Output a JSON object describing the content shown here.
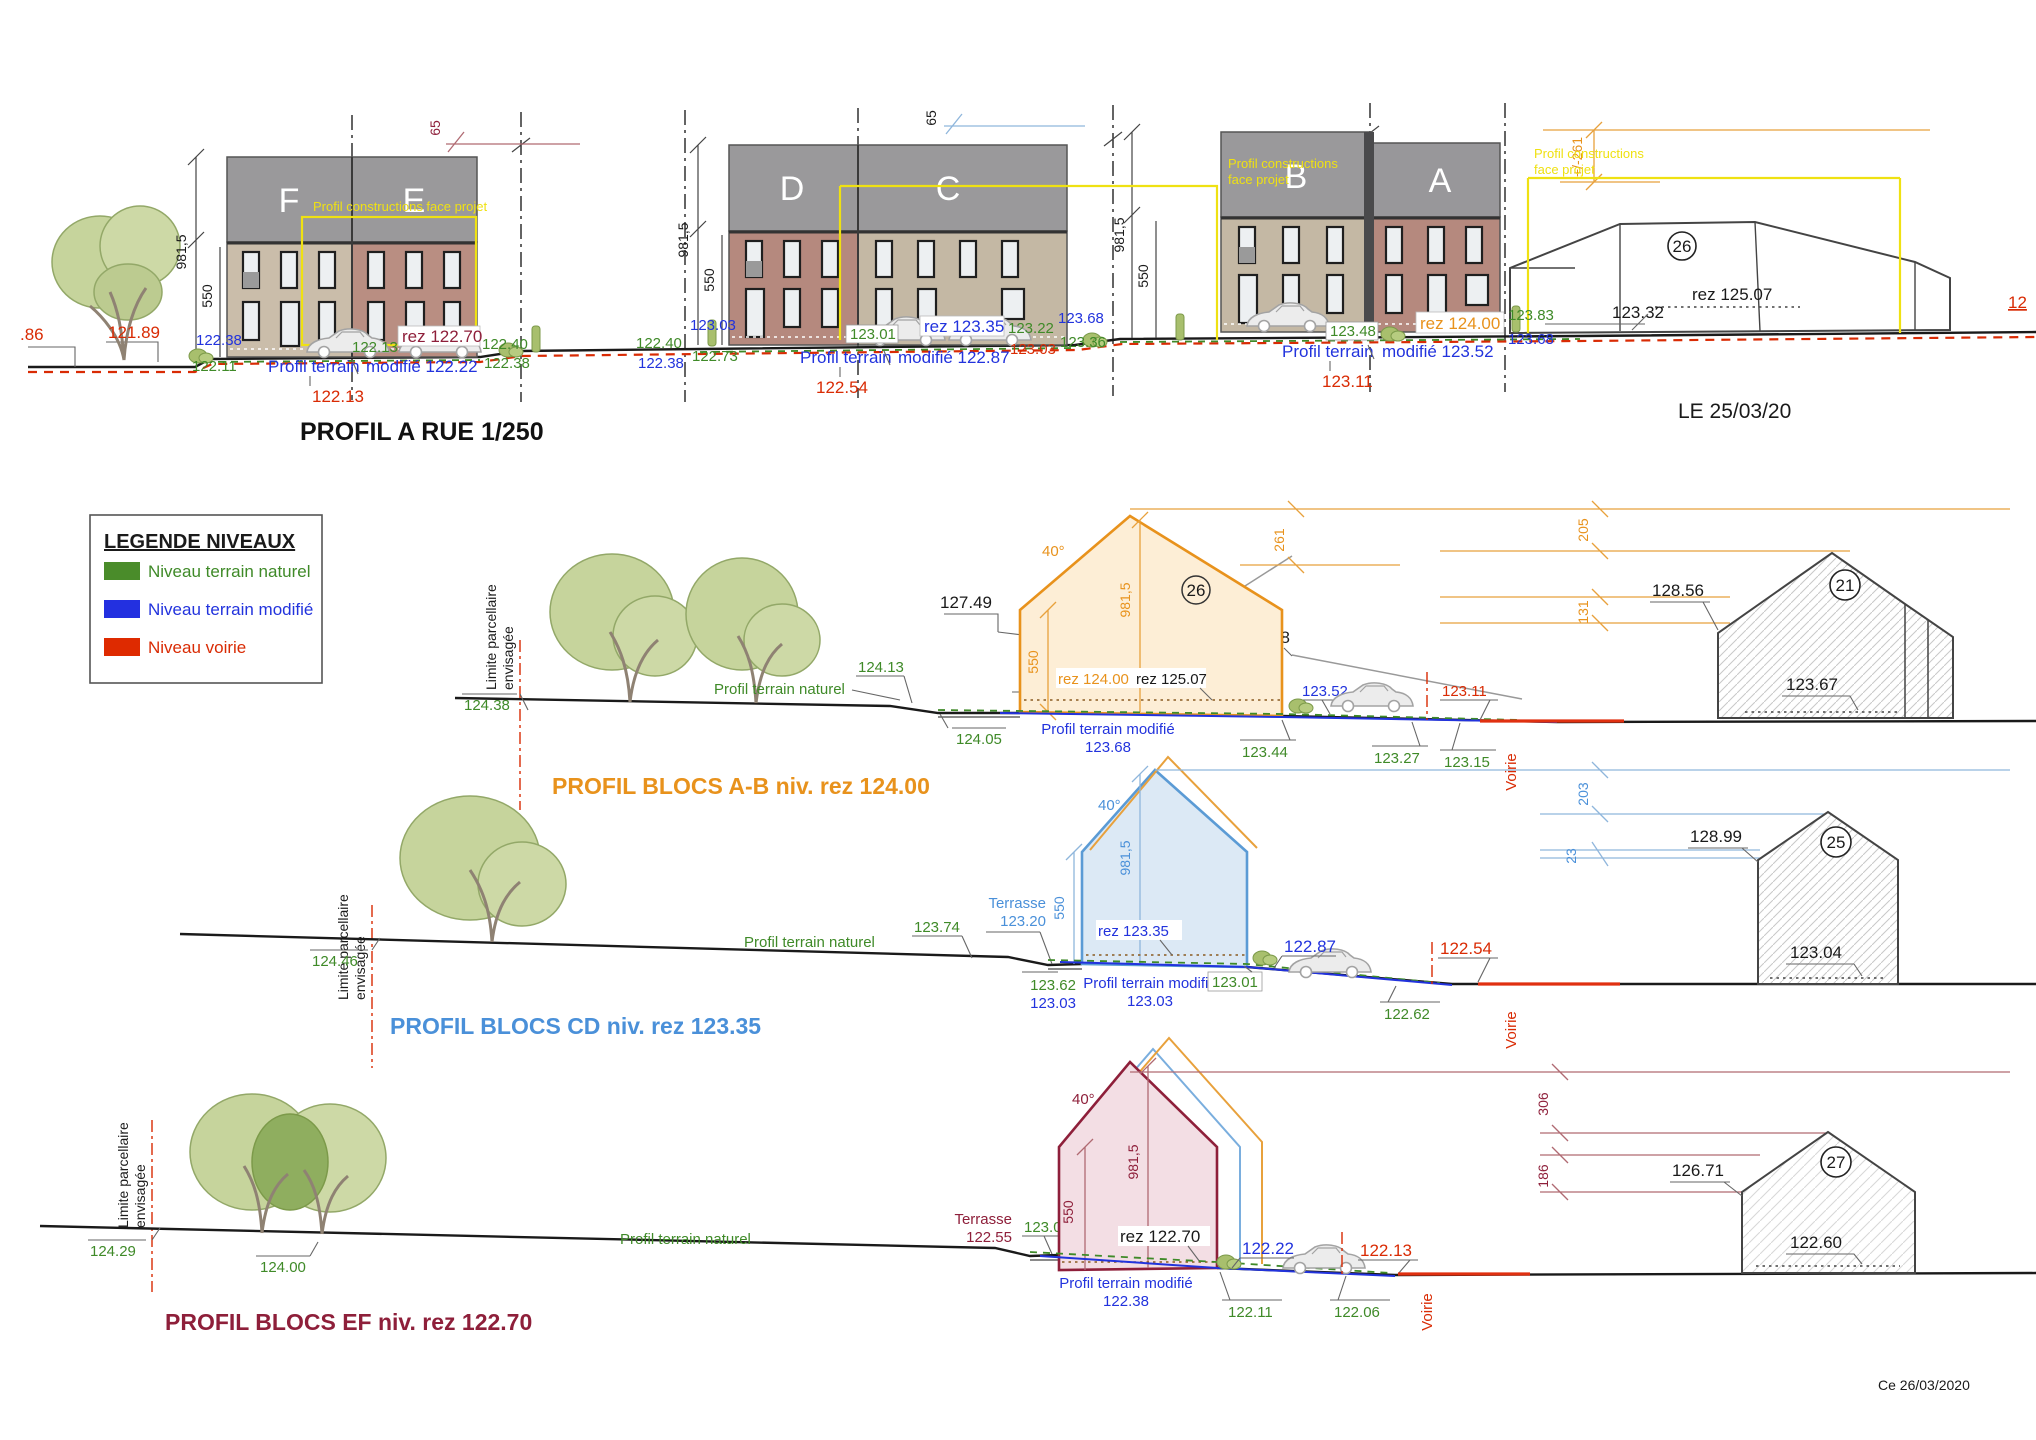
{
  "doc": {
    "footer": "Ce 26/03/2020"
  },
  "labels": {
    "construction": "Profil constructions face projet",
    "construction_l1": "Profil constructions",
    "construction_l2": "face projet",
    "limite_l1": "Limite parcellaire",
    "limite_l2": "envisagée",
    "terrain_naturel": "Profil terrain naturel",
    "terrain_modifie": "Profil terrain modifié",
    "profil_terrain": "Profil terrain",
    "terrasse": "Terrasse",
    "voirie": "Voirie",
    "angle": "40°",
    "h981": "981,5",
    "h550": "550",
    "d65": "65",
    "d261": "+/-261"
  },
  "street": {
    "title": "PROFIL A RUE 1/250",
    "date": "LE 25/03/20",
    "left_cut": ".86",
    "tree_lvl": "121.89",
    "right_cut": "12",
    "blocks": {
      "f": "F",
      "e": "E",
      "d": "D",
      "c": "C",
      "b": "B",
      "a": "A"
    },
    "fe": {
      "bl": "122.38",
      "gl": "122.11",
      "gm": "122.13",
      "rez": "rez 122.70",
      "gr1": "122.40",
      "gr2": "122.38",
      "mod": "modifié 122.22",
      "red": "122.13"
    },
    "dc": {
      "gl0": "122.40",
      "bl0": "122.38",
      "bl": "123.03",
      "gl": "122.73",
      "gm": "123.01",
      "rez": "rez 123.35",
      "gr1": "123.22",
      "redr": "123.03",
      "br": "123.68",
      "gr2": "123.36",
      "mod": "modifié 122.87",
      "red": "122.54"
    },
    "ba": {
      "gl": "123.48",
      "rez": "rez 124.00",
      "gr1": "123.83",
      "br": "123.68",
      "mod": "modifié 123.52",
      "red": "123.11"
    },
    "h26": {
      "num": "26",
      "rez": "rez 125.07",
      "lvl": "123.32"
    }
  },
  "legend": {
    "title": "LEGENDE NIVEAUX",
    "items": [
      {
        "label": "Niveau terrain naturel",
        "color": "#4a8c2a"
      },
      {
        "label": "Niveau terrain modifié",
        "color": "#2330e0"
      },
      {
        "label": "Niveau voirie",
        "color": "#de2a00"
      }
    ]
  },
  "ab": {
    "title": "PROFIL BLOCS A-B niv. rez 124.00",
    "l1": "124.38",
    "n1": "124.13",
    "n2": "124.05",
    "t2": "123.85",
    "p1": "127.49",
    "p2": "128.78",
    "rez1": "rez 124.00",
    "rez2": "rez 125.07",
    "m2": "123.68",
    "b1": "123.52",
    "g1": "123.44",
    "g2": "123.27",
    "g3": "123.15",
    "r1": "123.11",
    "d1": "261",
    "d2": "205",
    "d3": "131",
    "num": "26",
    "h21": {
      "num": "21",
      "top": "128.56",
      "floor": "123.67"
    }
  },
  "cd": {
    "title": "PROFIL BLOCS CD niv. rez 123.35",
    "l1": "124.46",
    "n1": "123.74",
    "t2": "123.20",
    "rez": "rez 123.35",
    "gh1": "123.62",
    "bh1": "123.03",
    "m2": "123.03",
    "gh2": "123.01",
    "b1": "122.87",
    "r1": "122.54",
    "g2": "122.62",
    "d1": "203",
    "d2": "23",
    "h25": {
      "num": "25",
      "top": "128.99",
      "floor": "123.04"
    }
  },
  "ef": {
    "title": "PROFIL BLOCS EF niv. rez 122.70",
    "l1": "124.29",
    "n1": "124.00",
    "g0": "123.05",
    "t2": "122.55",
    "rez": "rez 122.70",
    "m2": "122.38",
    "b1": "122.22",
    "r1": "122.13",
    "g1": "122.11",
    "g2": "122.06",
    "d1": "306",
    "d2": "186",
    "h27": {
      "num": "27",
      "top": "126.71",
      "floor": "122.60"
    }
  }
}
